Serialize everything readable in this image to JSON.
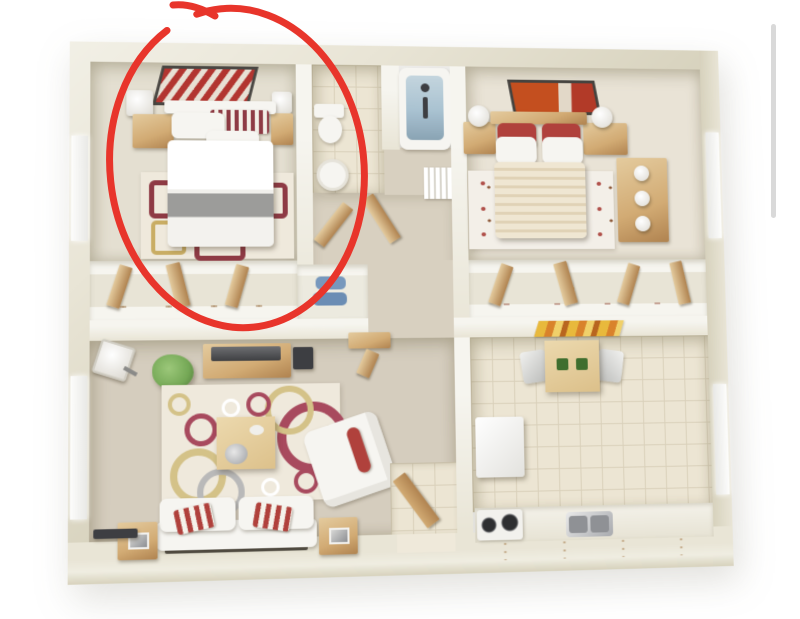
{
  "image": {
    "kind": "3d-floor-plan-render",
    "description": "Top-down 3D rendering of a two-bedroom apartment floor plan on a white background; the upper-left bedroom is circled with a hand-drawn red ellipse annotation; a thin gray scrollbar thumb is visible at the right edge."
  },
  "palette": {
    "bg": "#ffffff",
    "wall": "#e9e5d6",
    "wall_top": "#f6f5ef",
    "wall_shadow": "#d7d2bd",
    "carpet_bed1": "#e4dfd1",
    "carpet_bed2": "#e9e3d6",
    "carpet_hall": "#d8d0c0",
    "carpet_living": "#d5cdbe",
    "tile": "#ece5d3",
    "grout": "#d9d0ba",
    "wood": "#d2ab74",
    "wood_dark": "#b08350",
    "wood_light": "#e4cb9e",
    "white_furn": "#f6f5f1",
    "gray_blanket": "#9c9c9a",
    "accent_red": "#b0413c",
    "art_red": "#b23530",
    "rug_cream": "#efe9dc",
    "ring_crimson": "#a84a5e",
    "ring_gold": "#d4c288",
    "ring_gray": "#b9b9b9",
    "plant_green": "#76a957",
    "tub_blue": "#a9c2d1",
    "dark_gray": "#3d3e42",
    "annotation_red": "#e8352b",
    "scrollbar_gray": "#d9d9d9"
  },
  "annotation": {
    "shape": "hand-drawn ellipse",
    "color": "#e8352b",
    "stroke_width": 7,
    "center_x": 237,
    "center_y": 168,
    "radius_x": 127,
    "radius_y": 160,
    "rotation_deg": -6,
    "target": "bedroom-1 (upper-left bedroom)"
  },
  "scrollbar": {
    "visible": true,
    "x": 771,
    "y": 24,
    "width": 5,
    "height": 194,
    "color": "#d9d9d9"
  },
  "scene": {
    "rooms": [
      {
        "id": "bedroom-1",
        "position": "upper-left",
        "circled": true,
        "furniture": [
          "framed red abstract art on wall",
          "double bed with white duvet and gray throw blanket",
          "red-white striped headboard cushion",
          "white pillows",
          "wood nightstand with white lamp (left)",
          "wood nightstand with white lamp (right)",
          "cream rug with maroon rectangle pattern",
          "window on left wall",
          "closet with wood sliding doors and shoe shelf"
        ]
      },
      {
        "id": "bathroom",
        "position": "top-center",
        "furniture": [
          "toilet",
          "round white sink on vanity",
          "bathtub with blue glass shower",
          "beige tile floor"
        ]
      },
      {
        "id": "hallway",
        "position": "center",
        "furniture": [
          "open wood doors",
          "white slatted linen shelves",
          "laundry closet with blue items",
          "tan carpet"
        ]
      },
      {
        "id": "bedroom-2",
        "position": "upper-right",
        "circled": false,
        "furniture": [
          "framed red-orange art on wall",
          "double bed with cream striped duvet",
          "two red accent pillows",
          "white pillows",
          "wood nightstand with white lamp (left)",
          "wood nightstand with white lamp (right)",
          "wood dresser with round white knobs",
          "white rug with red floral accents",
          "window on right wall",
          "closet with wood sliding doors"
        ]
      },
      {
        "id": "living-room",
        "position": "lower-left",
        "furniture": [
          "wood TV console with flat TV",
          "dark speaker",
          "floor lamp with white square shade",
          "green potted plant",
          "small wood desk with stool",
          "cream area rug with red, gold and gray circles",
          "square wood coffee table with silver tray",
          "white armchair with red bolster cushion",
          "white sofa with two red-white striped pillows",
          "wood side table (left) with frame",
          "wood side table (right) with frame",
          "dark wall shelf",
          "window on left wall"
        ]
      },
      {
        "id": "kitchen",
        "position": "lower-right",
        "furniture": [
          "colorful striped wall art",
          "wood dining table with two green placemats",
          "two gray-white chairs",
          "white refrigerator",
          "white stove with two dark burners",
          "stainless double sink",
          "wood-front counter along bottom wall",
          "beige tile floor",
          "window on right wall"
        ]
      },
      {
        "id": "entry",
        "position": "bottom-center",
        "furniture": [
          "tiled entry floor",
          "open wood front door"
        ]
      }
    ]
  }
}
